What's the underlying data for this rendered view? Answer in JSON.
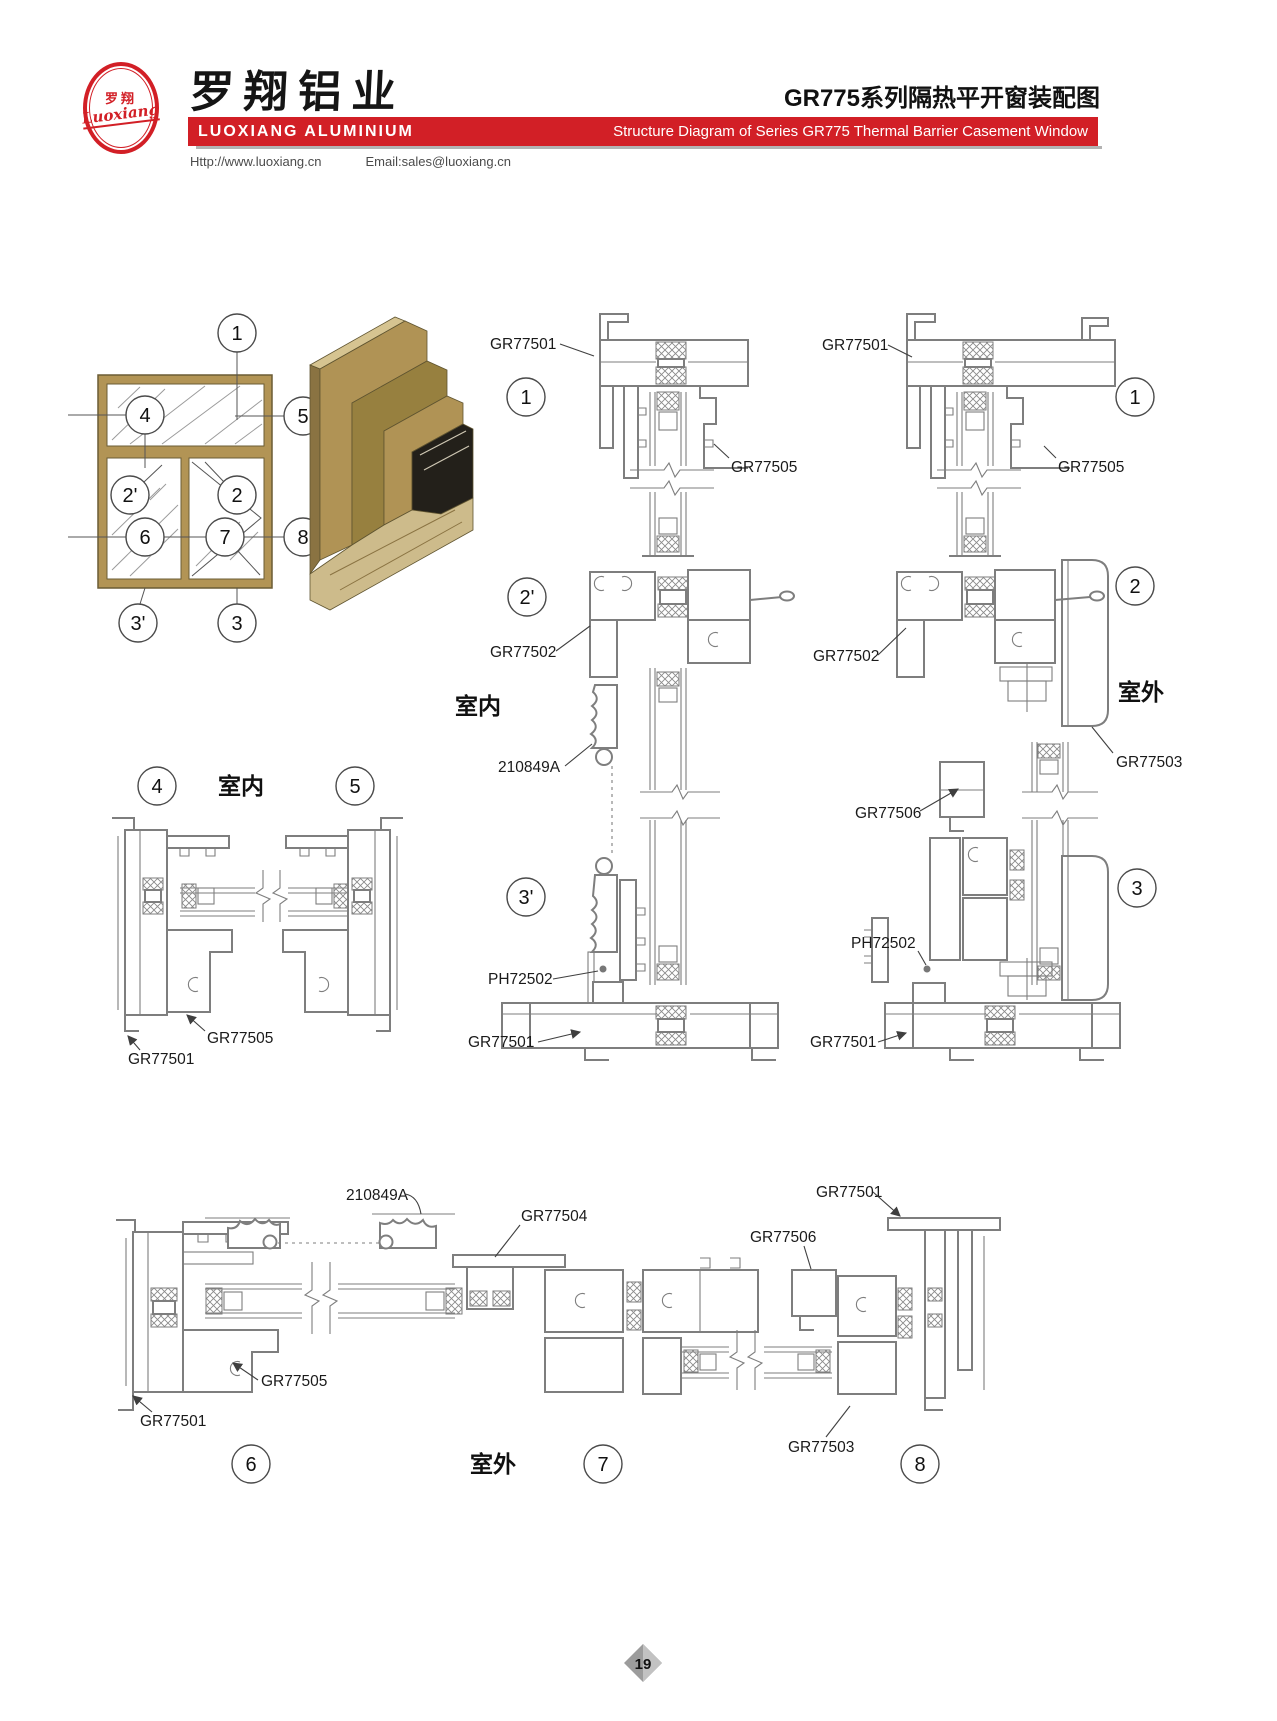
{
  "header": {
    "logo_cn": "罗翔",
    "logo_en": "Luoxiang",
    "company_cn": "罗翔铝业",
    "company_en": "LUOXIANG ALUMINIUM",
    "doc_title_cn": "GR775系列隔热平开窗装配图",
    "doc_title_en": "Structure Diagram of Series GR775 Thermal Barrier Casement Window",
    "website": "Http://www.luoxiang.cn",
    "email": "Email:sales@luoxiang.cn"
  },
  "parts": {
    "frame": "GR77501",
    "transom": "GR77502",
    "outer_frame": "GR77503",
    "mullion_t": "GR77504",
    "sash": "GR77505",
    "sash_small": "GR77506",
    "bead": "PH72502",
    "cover": "210849A"
  },
  "rooms": {
    "indoor": "室内",
    "outdoor": "室外"
  },
  "callouts": {
    "c1": "1",
    "c2": "2",
    "c2p": "2'",
    "c3": "3",
    "c3p": "3'",
    "c4": "4",
    "c5": "5",
    "c6": "6",
    "c7": "7",
    "c8": "8"
  },
  "footer": {
    "page_number": "19"
  },
  "colors": {
    "brand_red": "#d21f26",
    "profile_tan": "#b29455",
    "line_gray": "#7e7e7e"
  }
}
